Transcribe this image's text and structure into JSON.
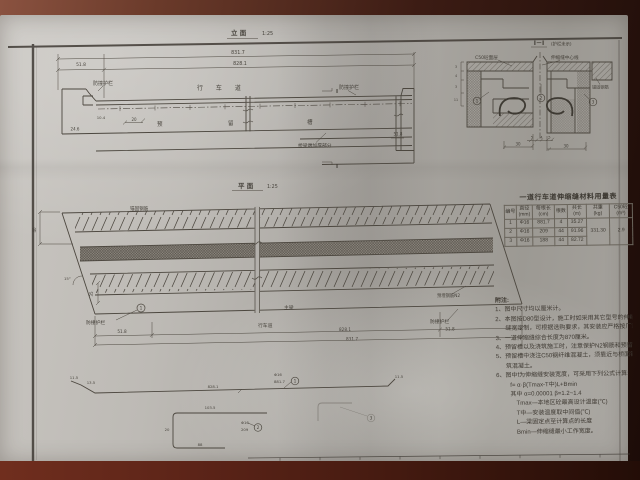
{
  "sheet": {
    "elevation": {
      "title": "立 面",
      "scale": "1:25",
      "dims": {
        "total": "831.7",
        "inner": "828.1",
        "left": "51.8",
        "right_small": "51.8",
        "h_left": "24.6",
        "d1": "10.4",
        "d2": "20"
      },
      "labels": {
        "barrier_left": "防撞护栏",
        "barrier_right": "防撞护栏",
        "roadway": "行 车 道",
        "groove_1": "预",
        "groove_2": "留",
        "groove_3": "槽",
        "thickened": "桥梁端加厚部分",
        "section_mark_top": "I",
        "section_mark_bottom": "I"
      }
    },
    "section": {
      "title": "I－I",
      "subtitle": "(护栏未示)",
      "labels": {
        "surface": "C50砼面层",
        "centerline": "伸缩缝中心线",
        "anchor": "锚固钢筋"
      },
      "callouts": [
        "1",
        "2",
        "3"
      ],
      "dims": {
        "left_col": [
          "3",
          "4",
          "3",
          "11"
        ],
        "bottom_small": [
          "5",
          "4",
          "5"
        ],
        "bottom_left": "30",
        "bottom_right": "30"
      }
    },
    "plan": {
      "title": "平 面",
      "scale": "1:25",
      "labels": {
        "anchor_bars": "锚固钢筋",
        "plate": "预埋钢筋N2",
        "barrier_left": "防撞护栏",
        "barrier_right": "防撞护栏",
        "roadway": "行车道",
        "girder": "主梁",
        "callout": "1",
        "angle": "15°"
      },
      "dims": {
        "band_w": "40",
        "edge_w": "35",
        "left": "51.8",
        "inner": "828.1",
        "right": "51.8",
        "total": "831.7"
      }
    },
    "table": {
      "title": "一道行车道伸缩缝材料用量表",
      "headers": [
        [
          "编号",
          ""
        ],
        [
          "直径",
          "(mm)"
        ],
        [
          "每根长",
          "(cm)"
        ],
        [
          "根数",
          ""
        ],
        [
          "共长",
          "(m)"
        ],
        [
          "共重",
          "(kg)"
        ],
        [
          "C50砼",
          "(m³)"
        ]
      ],
      "rows": [
        {
          "no": "1",
          "dia": "Φ16",
          "len": "881.7",
          "count": "4",
          "total_len": "35.27"
        },
        {
          "no": "2",
          "dia": "Φ16",
          "len": "209",
          "count": "44",
          "total_len": "91.96"
        },
        {
          "no": "3",
          "dia": "Φ16",
          "len": "188",
          "count": "44",
          "total_len": "82.72"
        }
      ],
      "total_weight": "331.30",
      "concrete": "2.9"
    },
    "notes": {
      "title": "附注:",
      "lines": [
        "1、图中尺寸均以厘米计。",
        "2、本图按D80型设计，施工时如采用其它型号的伸缩缝时按伸缩",
        "缝宽定制，可根据选购要求，其安装应严格按厂家要求进行。",
        "3、一道伸缩缝综合长度为870厘米。",
        "4、预留槽以及浇筑施工时，注意保护N2钢筋和预留槽钢筋N3。",
        "5、预留槽中浇注C50钢纤维混凝土，须靠近与桥面铺装同时浇",
        "筑混凝土。",
        "6、图中f为伸缩缝安装宽度，可采用下列公式计算:",
        "f= α·β(Tmax-T中)L+Bmin",
        "其中 α=0.00001      β=1.2~1.4",
        "Tmax—本地区砼最高设计温度(℃)",
        "T中—安装温度取中间值(℃)",
        "L—梁固定点至计算点的长度",
        "Bmin—伸缩缝最小工作宽度。"
      ]
    },
    "bars": {
      "bar1": {
        "d1": "11.5",
        "d2": "13.5",
        "mid": "828.1",
        "spec": "Φ16",
        "len": "881.7",
        "no": "1",
        "d3": "11.5"
      },
      "bar2": {
        "top": "103.5",
        "left": "20",
        "bottom": "88",
        "spec": "Φ16",
        "len": "209",
        "no": "2"
      },
      "bar3": {
        "no": "3"
      }
    }
  }
}
